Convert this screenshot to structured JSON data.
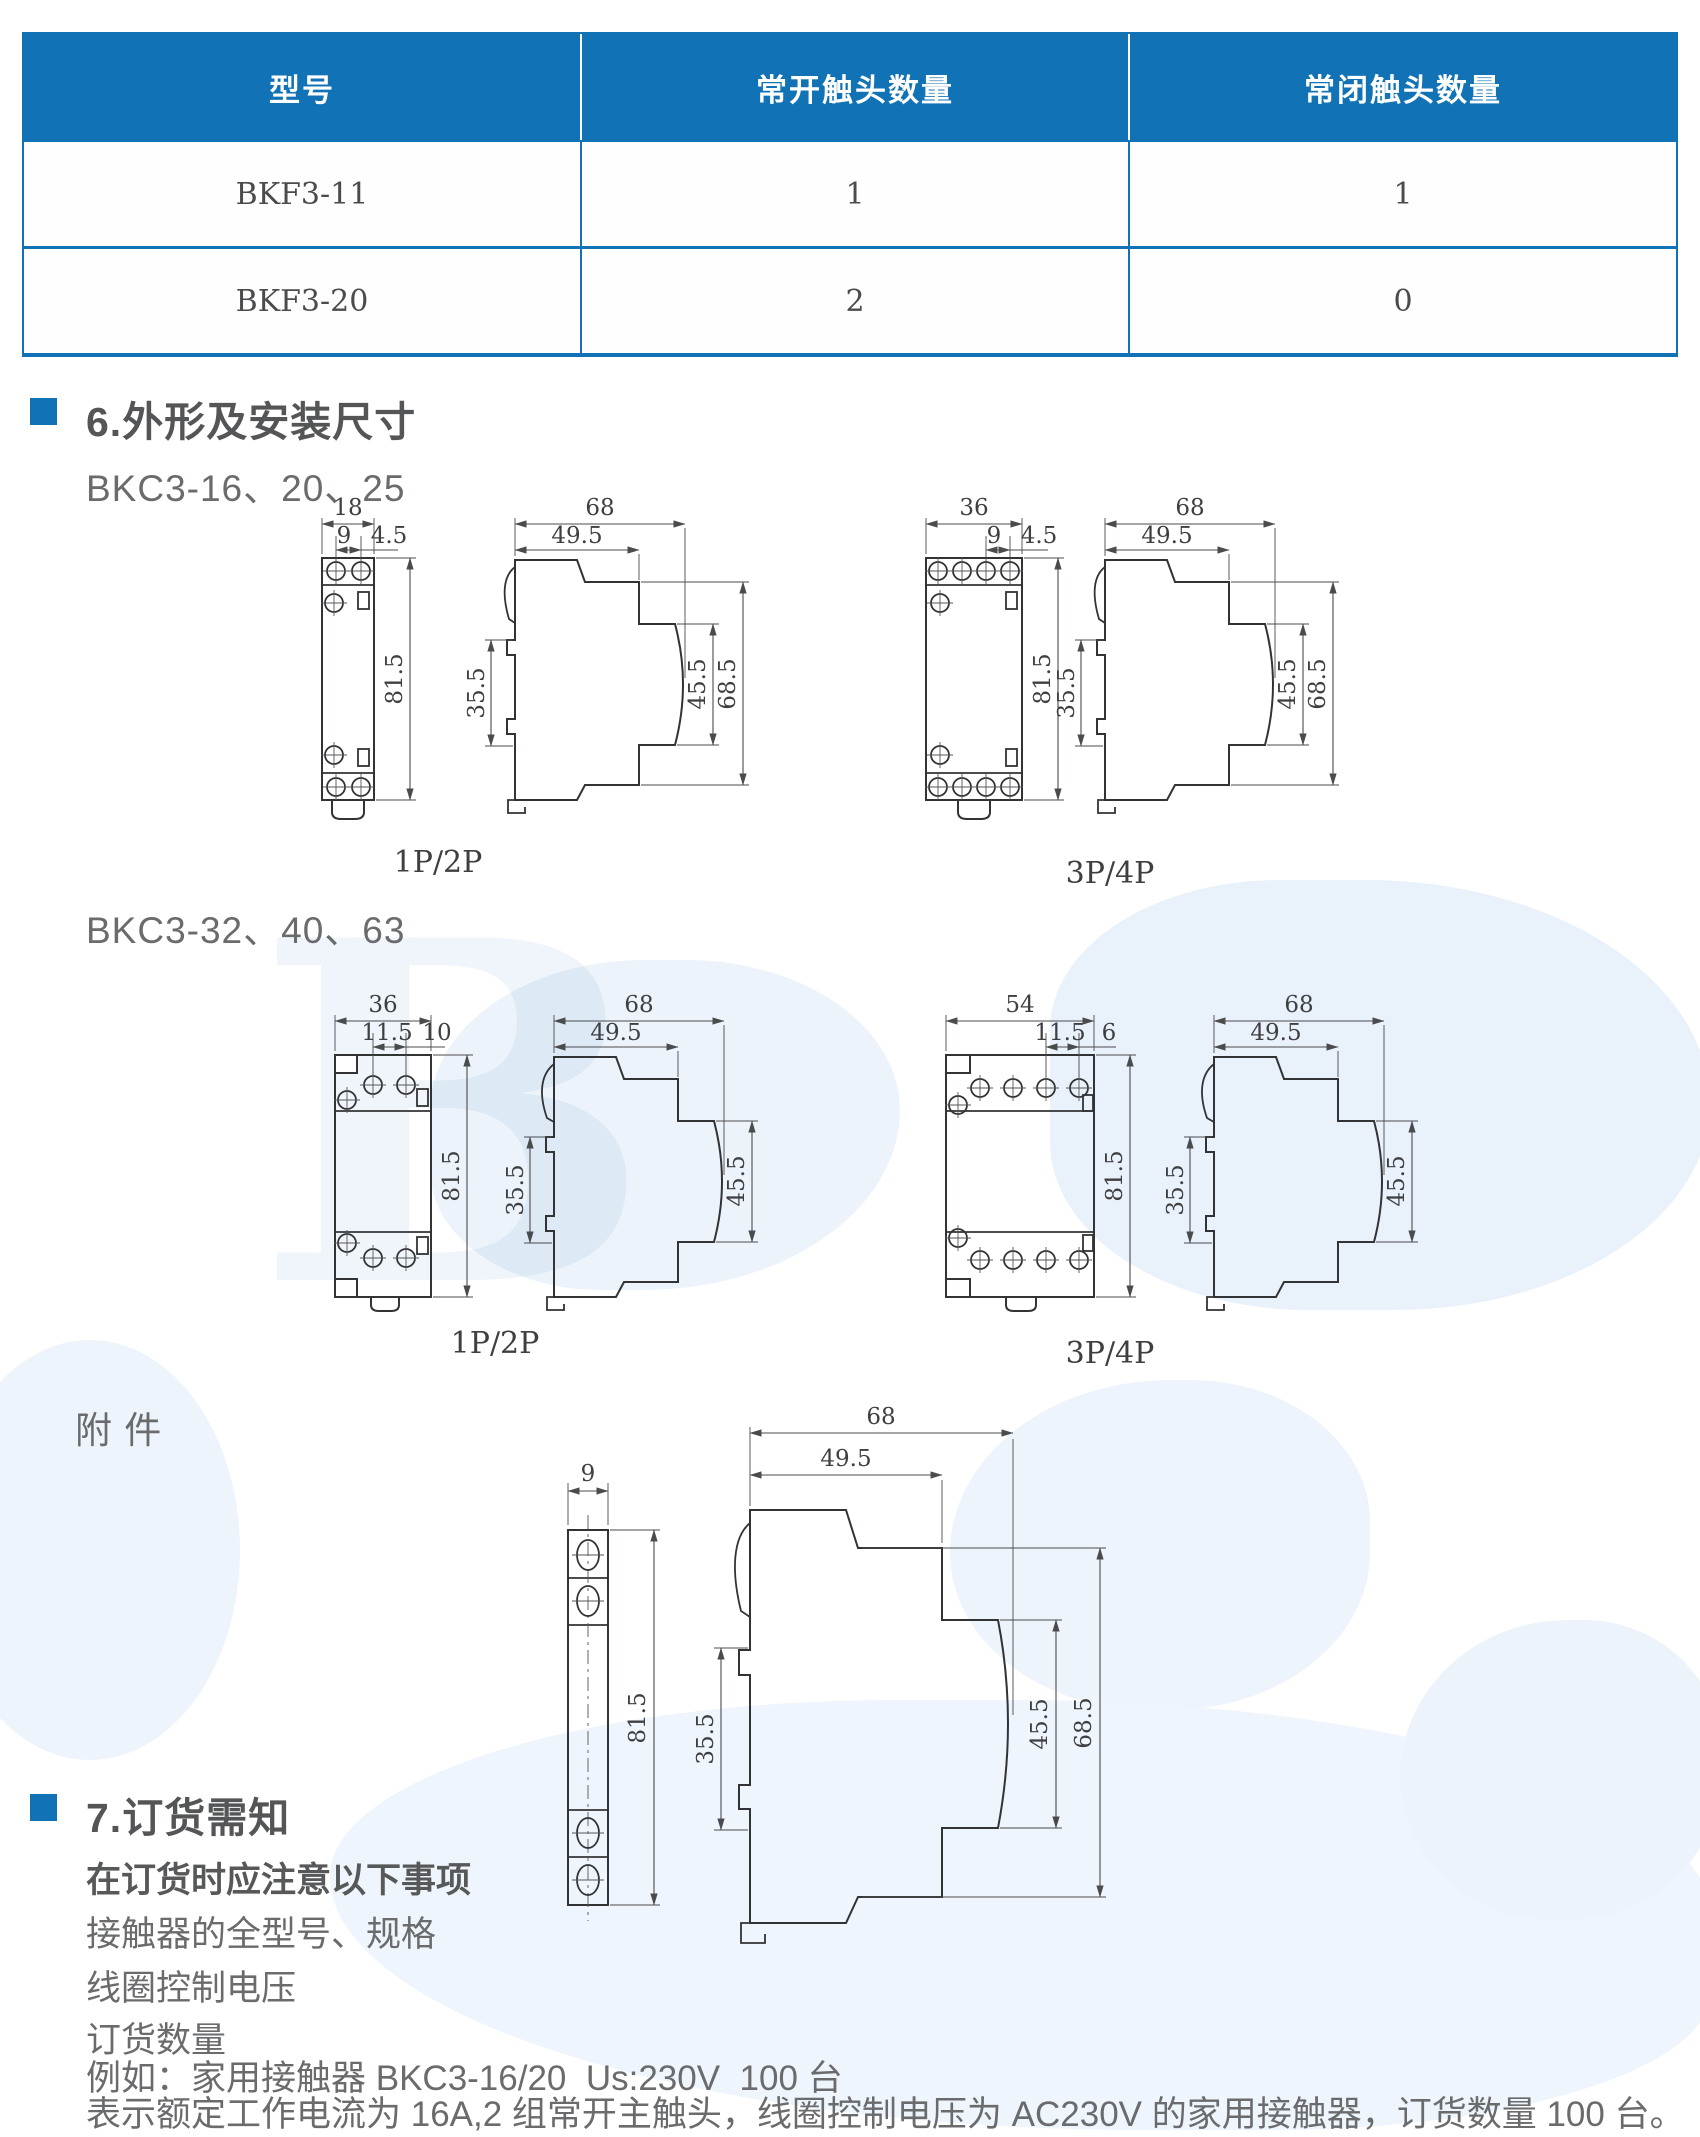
{
  "colors": {
    "accent": "#1173b5",
    "heading_text": "#545557",
    "body_text": "#6a6b6d",
    "line": "#323335"
  },
  "watermark": {
    "letter": "B"
  },
  "table": {
    "headers": [
      "型号",
      "常开触头数量",
      "常闭触头数量"
    ],
    "rows": [
      {
        "model": "BKF3-11",
        "no_contacts": "1",
        "nc_contacts": "1"
      },
      {
        "model": "BKF3-20",
        "no_contacts": "2",
        "nc_contacts": "0"
      }
    ]
  },
  "section6": {
    "title": "6.外形及安装尺寸",
    "group1_label": "BKC3-16、20、25",
    "group2_label": "BKC3-32、40、63",
    "accessory_label": "附 件",
    "sets": {
      "s1": {
        "caption": "1P/2P",
        "w": "18",
        "pitch": "9",
        "edge": "4.5",
        "h": "81.5",
        "depth": "68",
        "depth2": "49.5",
        "rail": "35.5",
        "front1": "45.5",
        "front2": "68.5"
      },
      "s2": {
        "caption": "3P/4P",
        "w": "36",
        "pitch": "9",
        "edge": "4.5",
        "h": "81.5",
        "depth": "68",
        "depth2": "49.5",
        "rail": "35.5",
        "front1": "45.5",
        "front2": "68.5"
      },
      "s3": {
        "caption": "1P/2P",
        "w": "36",
        "pitch": "11.5",
        "edge": "10",
        "h": "81.5",
        "depth": "68",
        "depth2": "49.5",
        "rail": "35.5",
        "front1": "45.5"
      },
      "s4": {
        "caption": "3P/4P",
        "w": "54",
        "pitch": "11.5",
        "edge": "6",
        "h": "81.5",
        "depth": "68",
        "depth2": "49.5",
        "rail": "35.5",
        "front1": "45.5"
      },
      "acc": {
        "w": "9",
        "h": "81.5",
        "depth": "68",
        "depth2": "49.5",
        "rail": "35.5",
        "front1": "45.5",
        "front2": "68.5"
      }
    }
  },
  "section7": {
    "title": "7.订货需知",
    "note_title": "在订货时应注意以下事项",
    "items": [
      "接触器的全型号、规格",
      "线圈控制电压",
      "订货数量"
    ],
    "example": "例如：家用接触器 BKC3-16/20  Us:230V  100 台",
    "explanation": "表示额定工作电流为 16A,2 组常开主触头，线圈控制电压为 AC230V 的家用接触器，订货数量 100 台。"
  }
}
